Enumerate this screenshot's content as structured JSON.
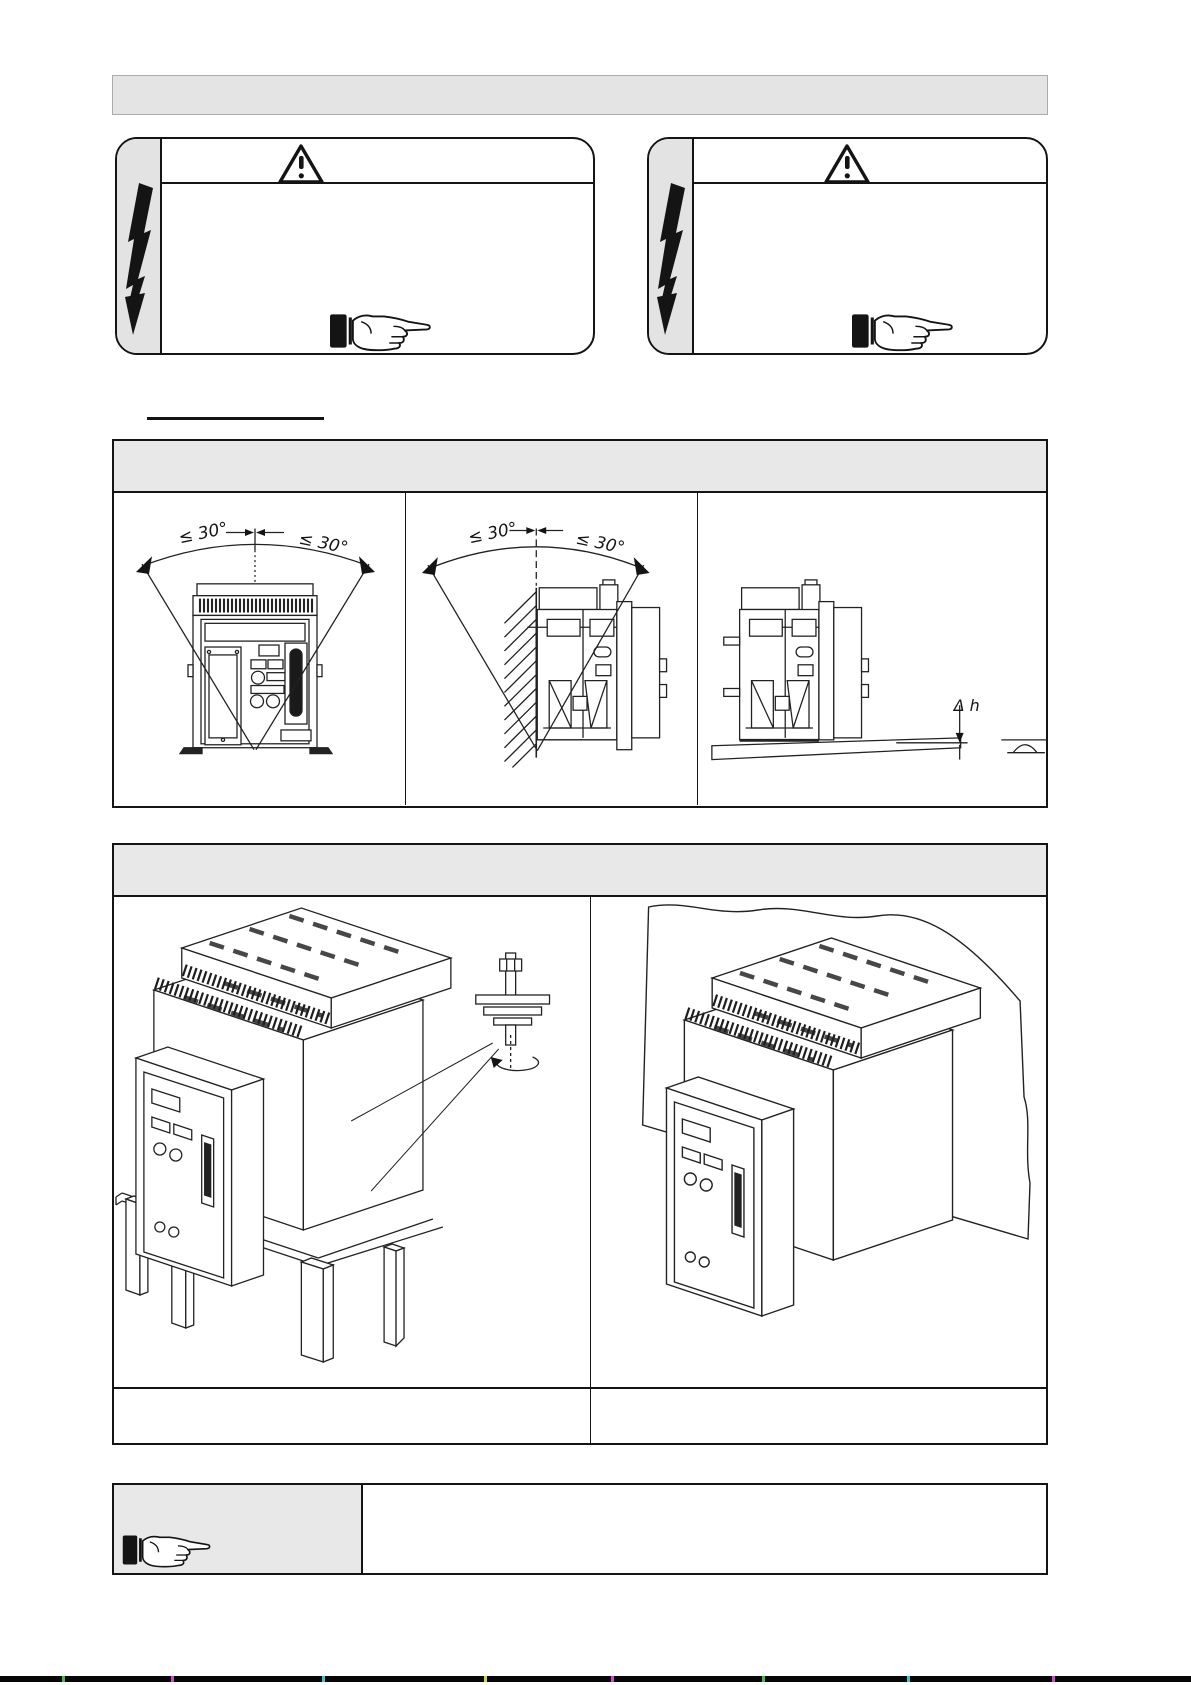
{
  "page": {
    "background": "#ffffff",
    "ink": "#141414",
    "header_bar_gray": "#e4e4e4",
    "section_header_gray": "#e8e8e8",
    "warning_stripe_gray": "#e3e3e3"
  },
  "icons": {
    "warning_triangle": "warning-triangle-exclamation",
    "lightning": "lightning-arrow-down",
    "pointing_hand": "pointing-hand-right"
  },
  "labels": {
    "angle_front_left": "≤ 30°",
    "angle_front_right": "≤ 30°",
    "angle_side_left": "≤ 30°",
    "angle_side_right": "≤ 30°",
    "height_difference": "Δ h"
  }
}
